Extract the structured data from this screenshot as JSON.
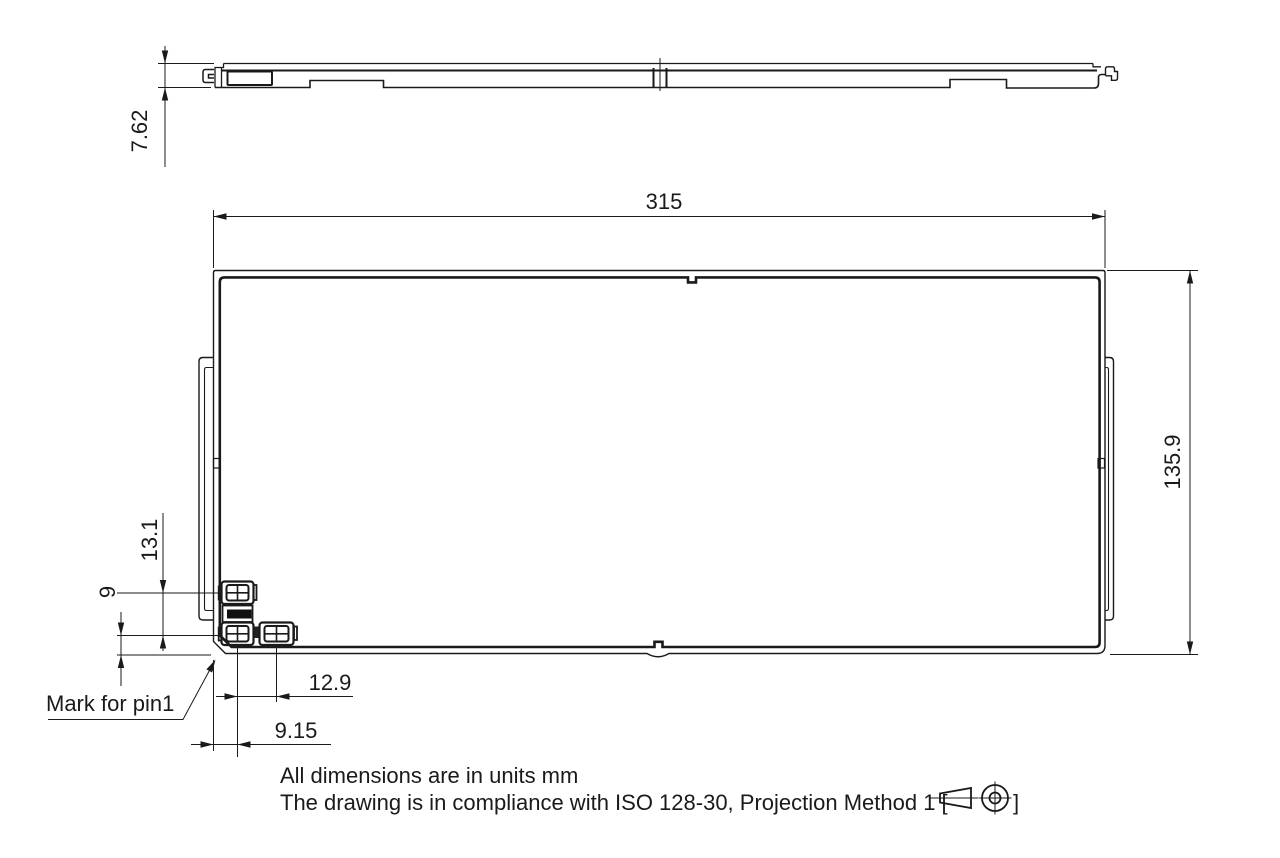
{
  "dimensions": {
    "thickness": "7.62",
    "width": "315",
    "height": "135.9",
    "connector_row_offset": "13.1",
    "connector_bottom_offset": "9",
    "connector_pitch": "12.9",
    "pin1_offset": "9.15"
  },
  "labels": {
    "pin1": "Mark for pin1"
  },
  "notes": {
    "units": "All dimensions are in units mm",
    "compliance_prefix": "The drawing is in compliance with ISO 128-30, Projection Method 1 [",
    "compliance_suffix": "]"
  },
  "colors": {
    "line": "#1a1a1a",
    "background": "#ffffff",
    "fill_dark": "#111111"
  }
}
